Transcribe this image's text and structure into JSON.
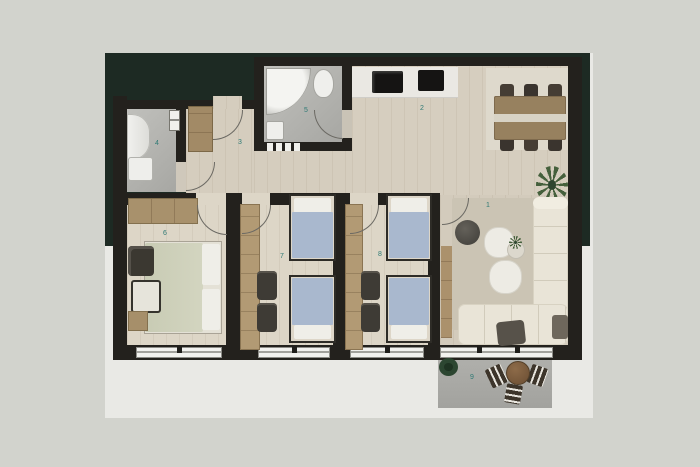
{
  "rooms": [
    {
      "key": "living-room",
      "number": "1"
    },
    {
      "key": "kitchen-dining",
      "number": "2"
    },
    {
      "key": "hallway",
      "number": "3"
    },
    {
      "key": "bathroom-1",
      "number": "4"
    },
    {
      "key": "bathroom-2",
      "number": "5"
    },
    {
      "key": "master-bedroom",
      "number": "6"
    },
    {
      "key": "bedroom-2",
      "number": "7"
    },
    {
      "key": "bedroom-3",
      "number": "8"
    },
    {
      "key": "balcony",
      "number": "9"
    }
  ],
  "colors": {
    "outer_background": "#d2d3cd",
    "photo_background": "#e9e9e5",
    "backdrop_green": "#1d2a23",
    "wall": "#23211d",
    "wood_floor": "#d8d0c1",
    "tile_gray": "#b4b4b0",
    "bed_blue": "#a9b8ce",
    "duvet_sage": "#ccceb8",
    "sofa_cream": "#e9e4d7",
    "table_brown": "#97815f",
    "room_number_teal": "#2f7a75"
  }
}
